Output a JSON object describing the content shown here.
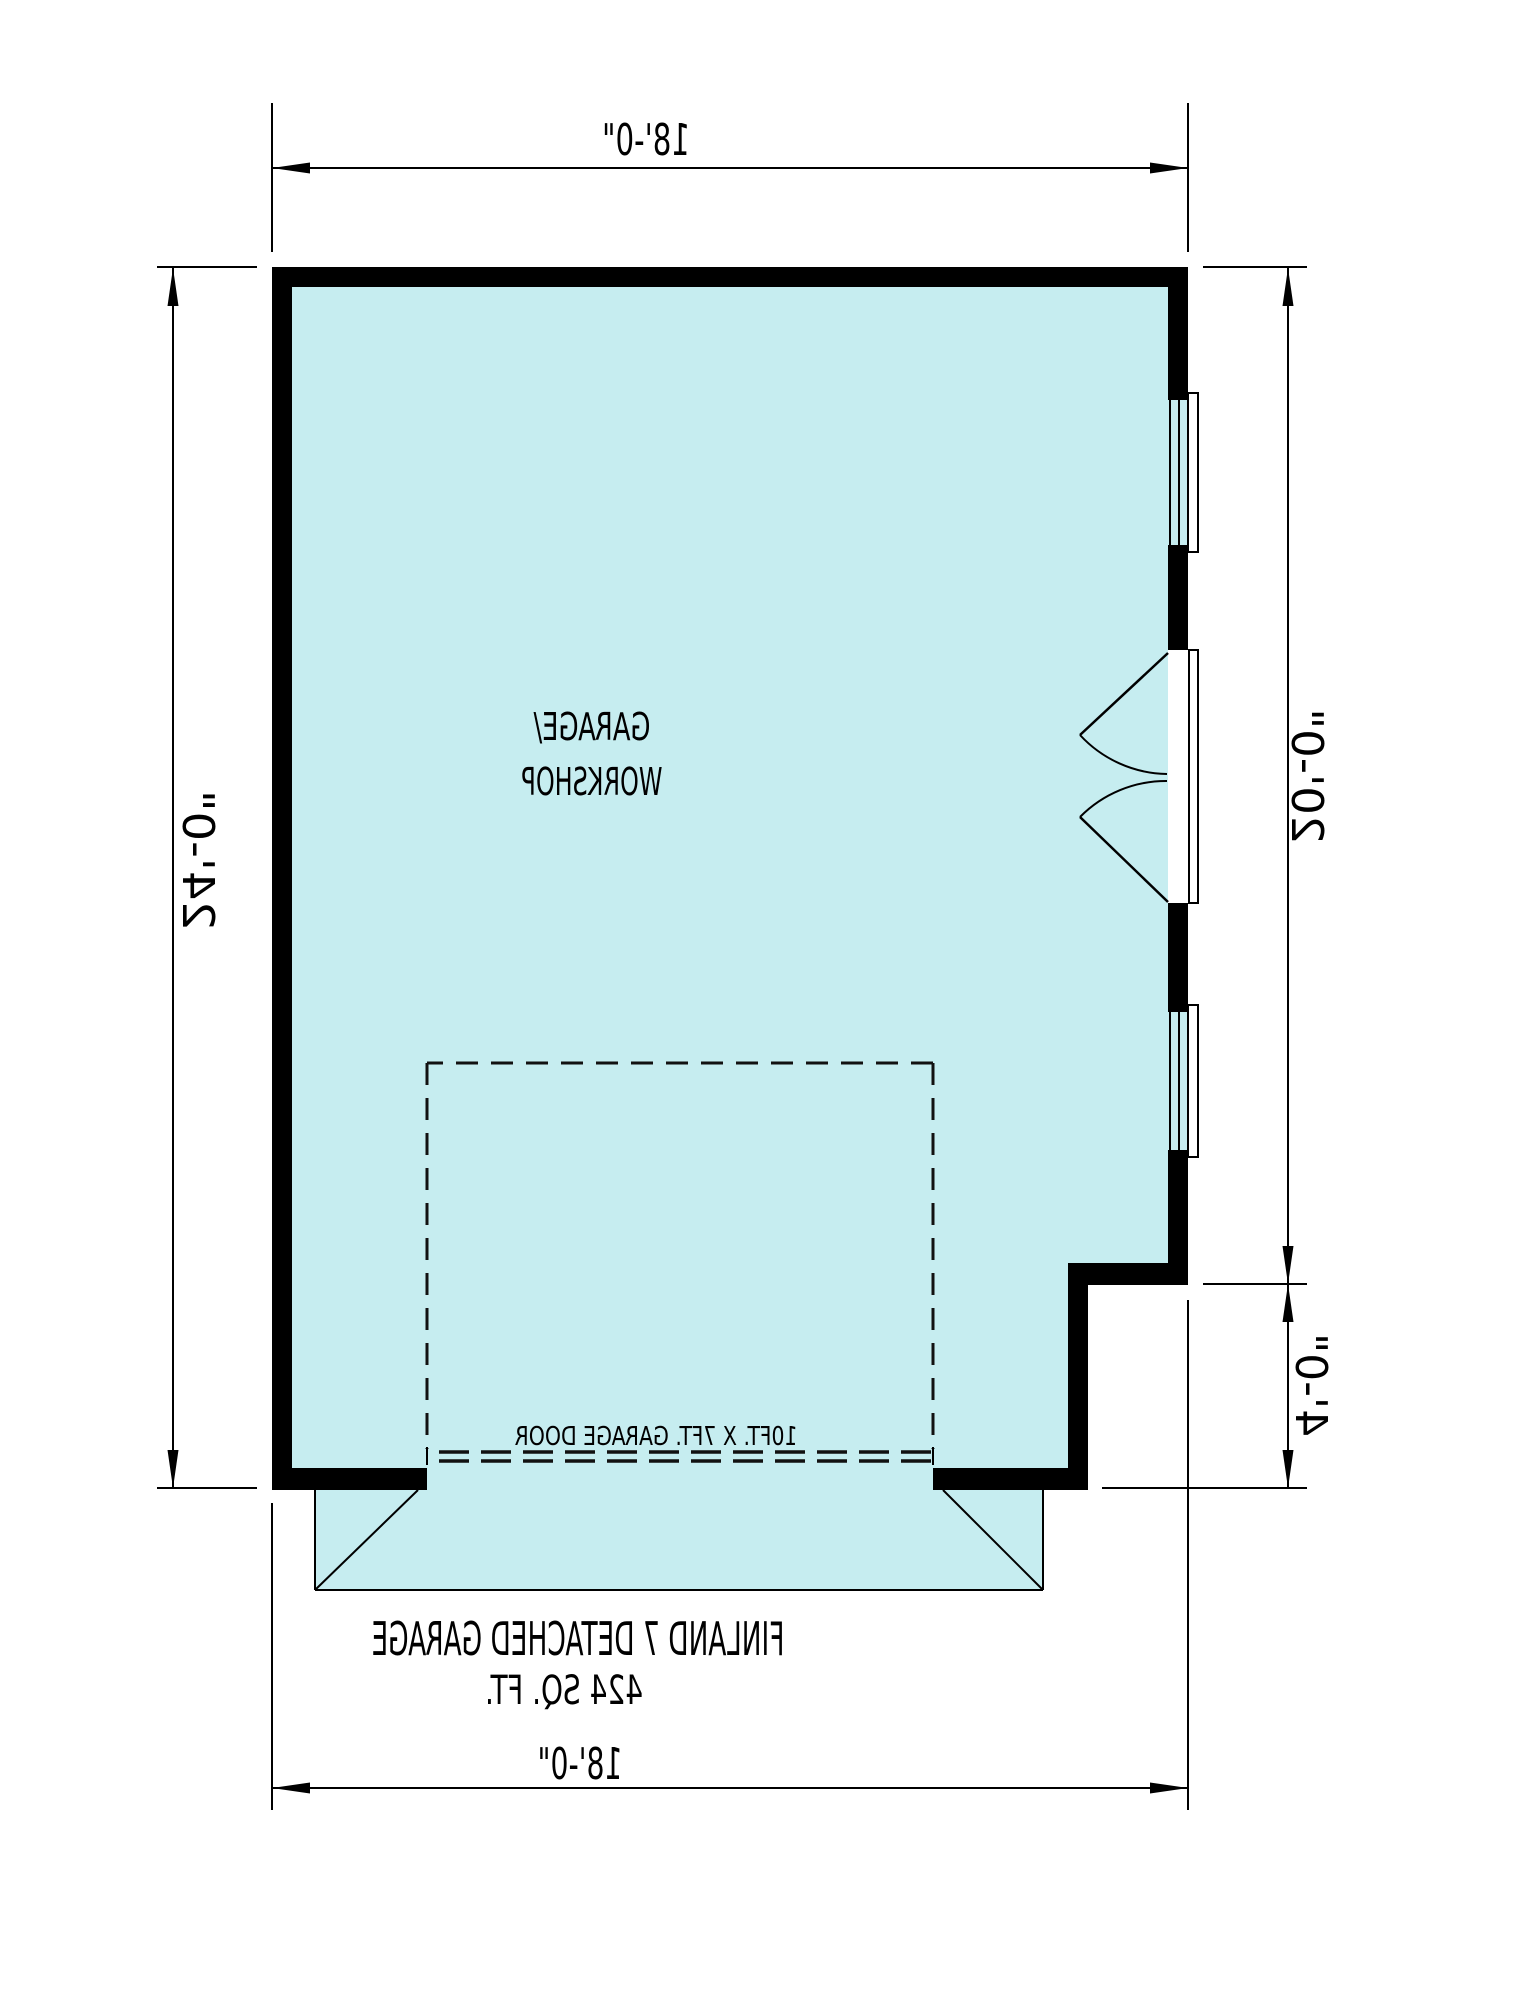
{
  "plan": {
    "room_label": [
      "GARAGE/",
      "WORKSHOP"
    ],
    "garage_door_label": "10FT. X 7FT. GARAGE DOOR",
    "title": "FINLAND 7 DETACHED GARAGE",
    "area_label": "424 SQ. FT.",
    "dims": {
      "top": "18'-0\"",
      "bottom": "18'-0\"",
      "left": "24'-0\"",
      "right_upper": "20'-0\"",
      "right_lower": "4'-0\""
    },
    "colors": {
      "floor_fill": "#c6edf0",
      "walls": "#000000",
      "lines": "#000000",
      "garage_door_text": "#3c4f52"
    }
  }
}
